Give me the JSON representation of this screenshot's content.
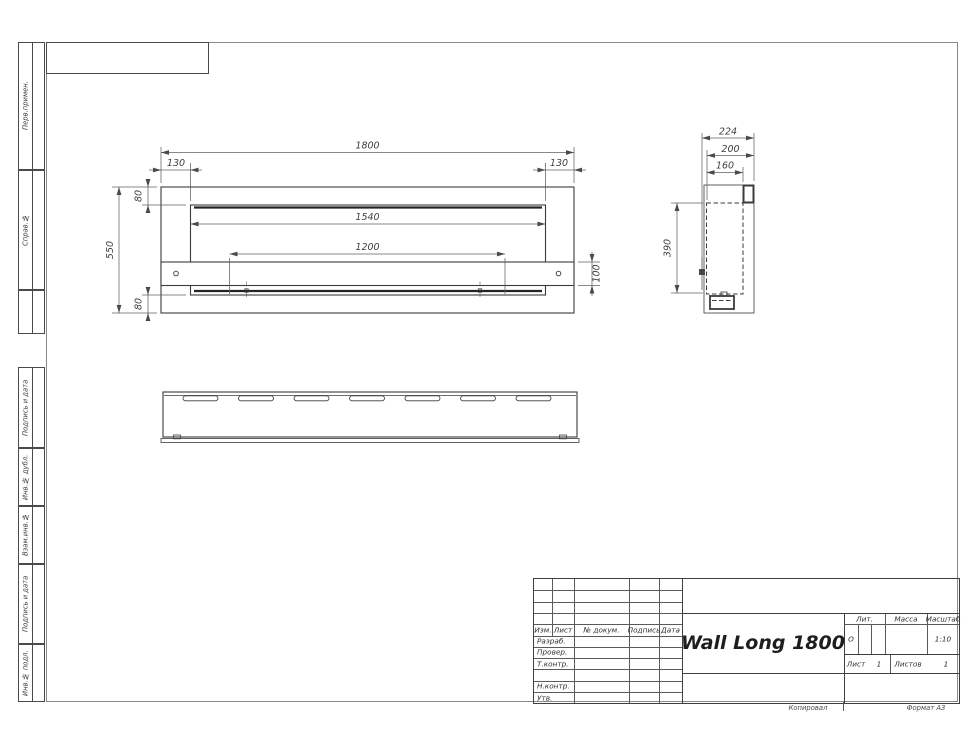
{
  "frame": {
    "copy_note": "Копировал",
    "format_note": "Формат А3"
  },
  "sidebar_left": {
    "top_sections": [
      {
        "label": "Перв.примен."
      },
      {
        "label": "Справ.№"
      },
      {
        "label": ""
      }
    ],
    "bottom_sections": [
      {
        "label": "Подпись и дата"
      },
      {
        "label": "Инв.№ дубл."
      },
      {
        "label": "Взам.инв.№"
      },
      {
        "label": "Подпись и дата"
      },
      {
        "label": "Инв.№ подл."
      }
    ]
  },
  "title_block": {
    "product_name": "Wall Long 1800",
    "revision_header": {
      "izm": "Изм.",
      "list": "Лист",
      "doc": "№ докум.",
      "sign": "Подпись",
      "date": "Дата"
    },
    "signature_rows": [
      {
        "label": "Разраб."
      },
      {
        "label": "Провер."
      },
      {
        "label": "Т.контр."
      },
      {
        "label": ""
      },
      {
        "label": "Н.контр."
      },
      {
        "label": "Утв."
      }
    ],
    "lit": {
      "label": "Лит.",
      "value": "О"
    },
    "mass": {
      "label": "Масса",
      "value": ""
    },
    "scale": {
      "label": "Масштаб",
      "value": "1:10"
    },
    "sheet": {
      "label": "Лист",
      "value": "1"
    },
    "sheets": {
      "label": "Листов",
      "value": "1"
    }
  },
  "drawing": {
    "dimensions": {
      "front_width": "1800",
      "front_height": "550",
      "left_inset": "130",
      "right_inset": "130",
      "top_margin": "80",
      "bottom_margin": "80",
      "opening_width": "1540",
      "burner_length": "1200",
      "shelf_height": "100",
      "depth": "224",
      "body_depth": "200",
      "inner_depth": "160",
      "opening_height": "390"
    }
  },
  "colors": {
    "outline": "#3b3b3b",
    "dim_line": "#606060",
    "frame_line": "#8a8a8a",
    "text": "#2e2e2e"
  }
}
